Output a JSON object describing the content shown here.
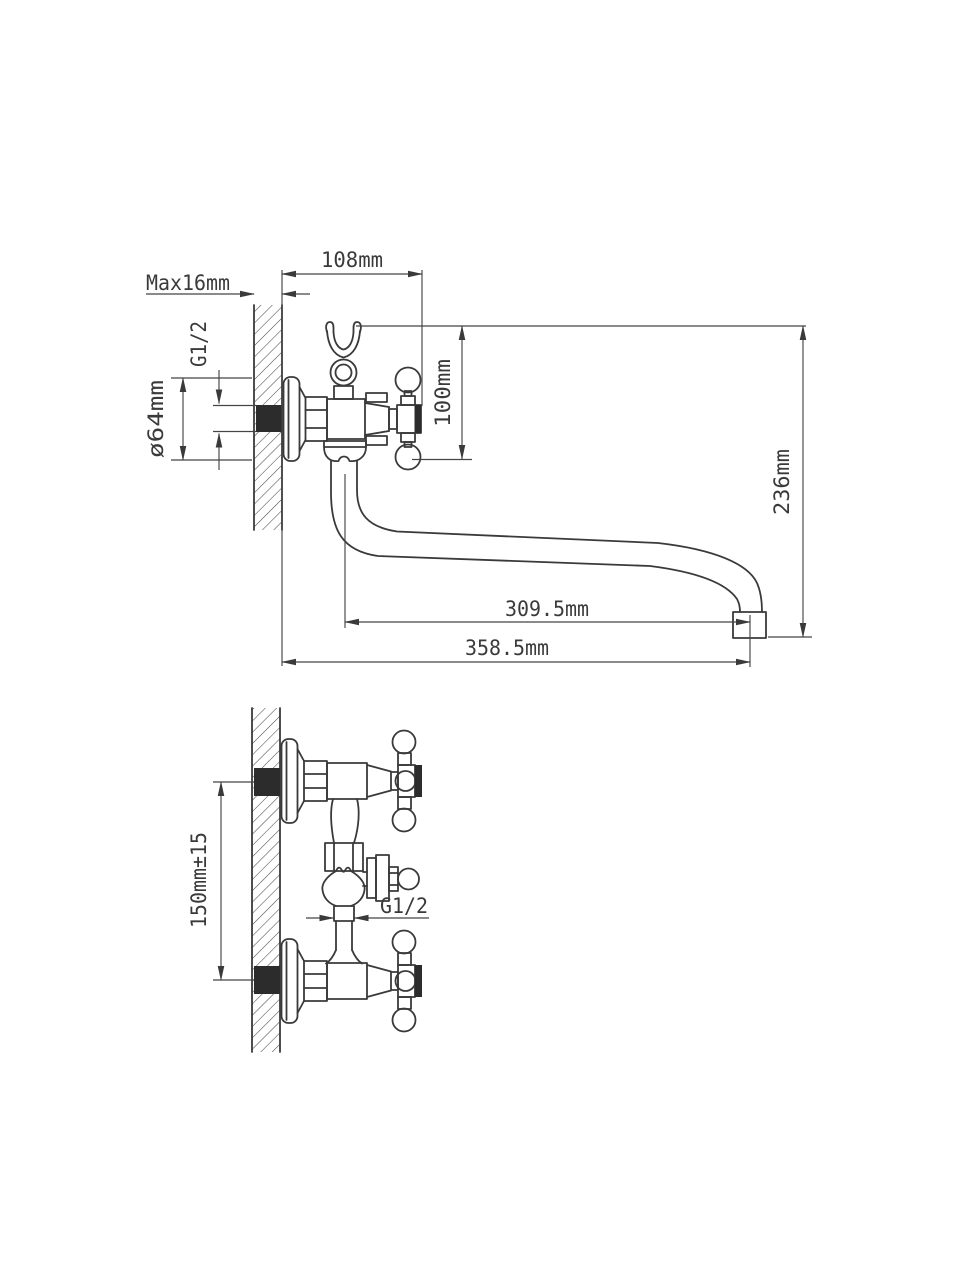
{
  "ink": "#3a3a3a",
  "dim_ink": "#454545",
  "background": "#ffffff",
  "side_view": {
    "dims": {
      "width_108": "108mm",
      "wall_max": "Max16mm",
      "inlet_thread": "G1/2",
      "flange_dia": "ø64mm",
      "body_height": "100mm",
      "overall_height": "236mm",
      "spout_reach": "309.5mm",
      "overall_reach": "358.5mm"
    }
  },
  "plan_view": {
    "dims": {
      "inlet_spacing": "150mm±15",
      "spout_thread": "G1/2"
    }
  }
}
